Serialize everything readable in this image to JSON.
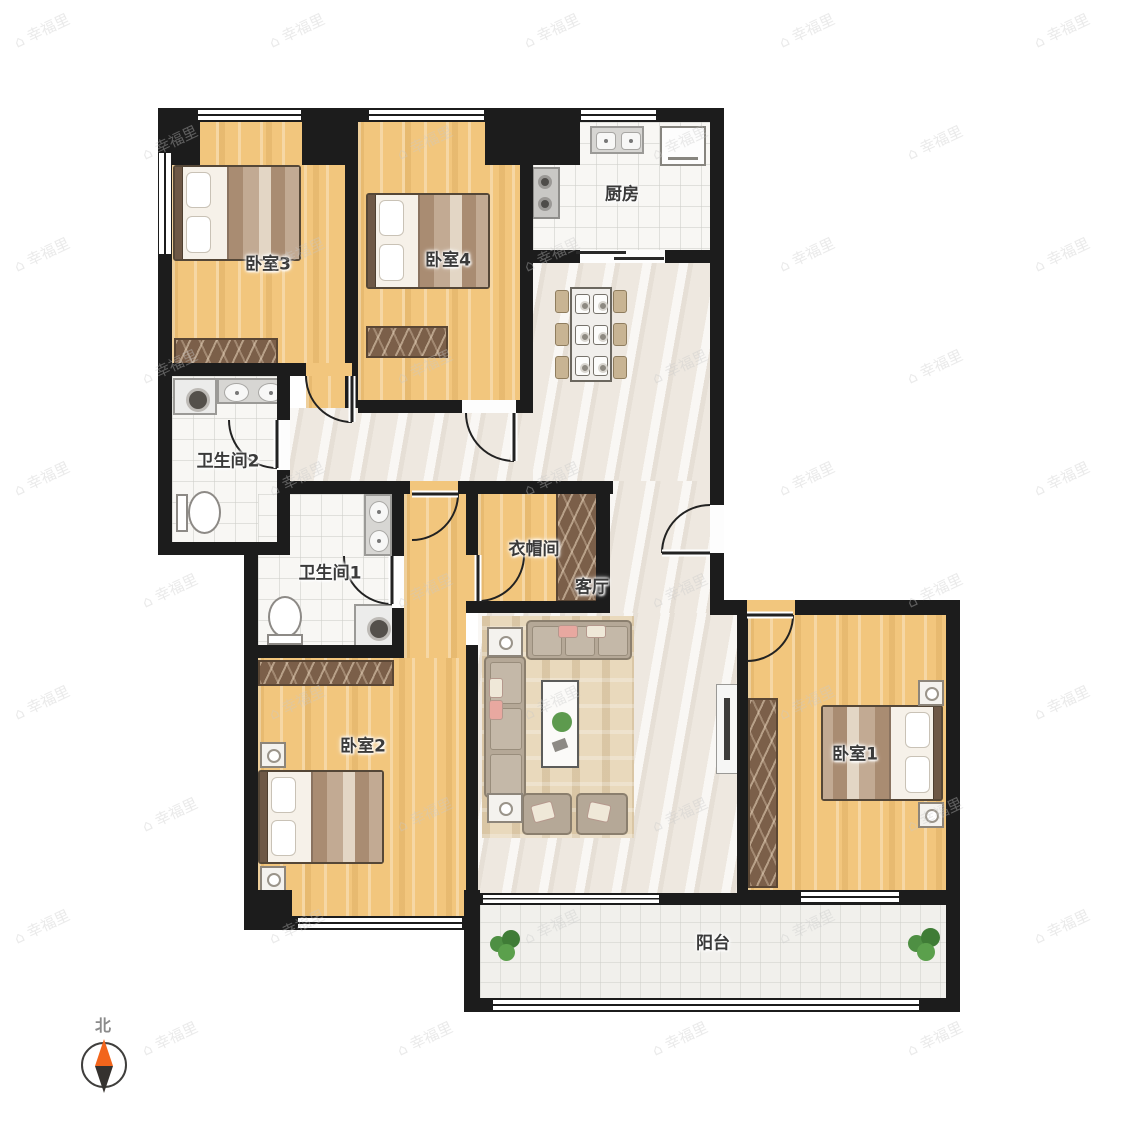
{
  "watermark": {
    "text": "幸福里",
    "icon": "house-icon"
  },
  "compass": {
    "north_label": "北",
    "needle_colors": {
      "north": "#f2651c",
      "south": "#35322f"
    }
  },
  "rooms": {
    "bedroom3": {
      "label": "卧室3"
    },
    "bedroom4": {
      "label": "卧室4"
    },
    "kitchen": {
      "label": "厨房"
    },
    "bathroom2": {
      "label": "卫生间2"
    },
    "bathroom1": {
      "label": "卫生间1"
    },
    "cloakroom": {
      "label": "衣帽间"
    },
    "living": {
      "label": "客厅"
    },
    "bedroom2": {
      "label": "卧室2"
    },
    "bedroom1": {
      "label": "卧室1"
    },
    "balcony": {
      "label": "阳台"
    }
  },
  "colors": {
    "wall": "#1c1c1c",
    "wood_floor": "#f2c67d",
    "tile_floor": "#eee8e0",
    "wardrobe": "#7b5f49",
    "compass_orange": "#f2651c",
    "plant_green": "#4e8f43"
  }
}
